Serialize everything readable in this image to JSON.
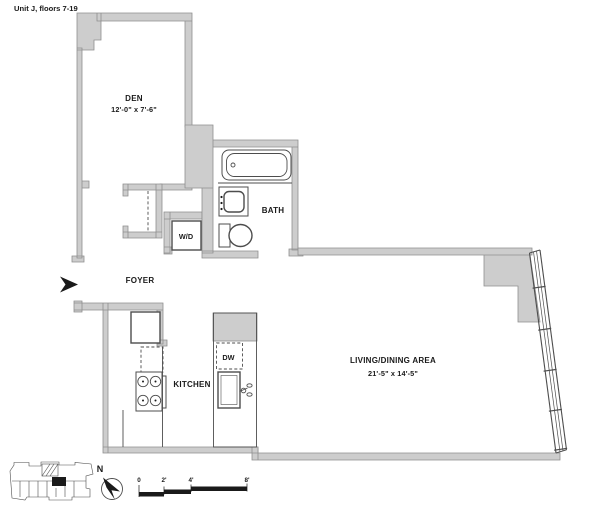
{
  "title": "Unit J, floors 7-19",
  "rooms": {
    "den": {
      "label": "DEN",
      "dimensions": "12'-0\" x 7'-6\""
    },
    "bath": {
      "label": "BATH"
    },
    "washer_dryer": {
      "label": "W/D"
    },
    "foyer": {
      "label": "FOYER"
    },
    "kitchen": {
      "label": "KITCHEN"
    },
    "dishwasher": {
      "label": "DW"
    },
    "living_dining": {
      "label": "LIVING/DINING AREA",
      "dimensions": "21'-5\" x 14'-5\""
    }
  },
  "compass": {
    "north_label": "N"
  },
  "scale_bar": {
    "tick_labels": [
      "0",
      "2'",
      "4'",
      "8'"
    ]
  },
  "colors": {
    "background": "#ffffff",
    "wall_fill": "#cdcdcd",
    "wall_outline": "#8f8f8f",
    "line": "#4d4d4d",
    "ink": "#1a1a1a"
  }
}
